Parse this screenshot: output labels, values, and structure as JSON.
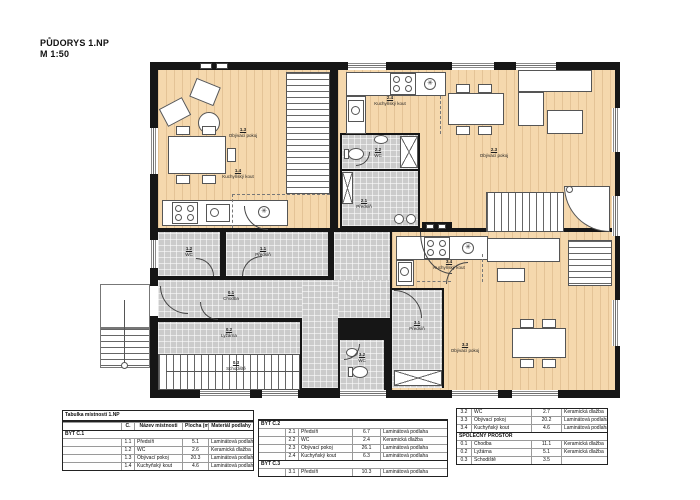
{
  "title": {
    "heading": "PŮDORYS 1.NP",
    "scale": "M 1:50"
  },
  "icons": {
    "boiler_glyph": "✳"
  },
  "colors": {
    "wall": "#161616",
    "wood_floor": "#f5d8ad",
    "tile_floor": "#cbcbcb"
  },
  "plan": {
    "rooms": [
      {
        "num": "1.3",
        "name": "Obývací pokoj"
      },
      {
        "num": "1.4",
        "name": "Kuchyňský kout"
      },
      {
        "num": "2.4",
        "name": "Kuchyňský kout"
      },
      {
        "num": "2.3",
        "name": "Obývací pokoj"
      },
      {
        "num": "2.2",
        "name": "WC"
      },
      {
        "num": "2.1",
        "name": "Předsíň"
      },
      {
        "num": "1.2",
        "name": "WC"
      },
      {
        "num": "1.1",
        "name": "Předsíň"
      },
      {
        "num": "0.1",
        "name": "Chodba"
      },
      {
        "num": "0.2",
        "name": "Lyžárna"
      },
      {
        "num": "0.3",
        "name": "Schodiště"
      },
      {
        "num": "3.2",
        "name": "WC"
      },
      {
        "num": "3.1",
        "name": "Předsíň"
      },
      {
        "num": "3.4",
        "name": "Kuchyňský kout"
      },
      {
        "num": "3.3",
        "name": "Obývací pokoj"
      }
    ]
  },
  "legend": {
    "title": "Tabulka místností 1.NP",
    "columns": [
      "Č.",
      "Název místnosti",
      "Plocha (m2)",
      "Materiál podlahy"
    ],
    "tables": [
      {
        "show_title": true,
        "show_colheader": true,
        "sections": [
          {
            "label": "BYT Č.1",
            "rows": [
              [
                "1.1",
                "Předsíň",
                "5.1",
                "Laminátová podlaha"
              ],
              [
                "1.2",
                "WC",
                "2.6",
                "Keramická dlažba"
              ],
              [
                "1.3",
                "Obývací pokoj",
                "20.3",
                "Laminátová podlaha"
              ],
              [
                "1.4",
                "Kuchyňský kout",
                "4.6",
                "Laminátová podlaha"
              ]
            ]
          }
        ]
      },
      {
        "show_title": false,
        "show_colheader": false,
        "sections": [
          {
            "label": "BYT Č.2",
            "rows": [
              [
                "2.1",
                "Předsíň",
                "6.7",
                "Laminátová podlaha"
              ],
              [
                "2.2",
                "WC",
                "2.4",
                "Keramická dlažba"
              ],
              [
                "2.3",
                "Obývací pokoj",
                "26.1",
                "Laminátová podlaha"
              ],
              [
                "2.4",
                "Kuchyňský kout",
                "6.3",
                "Laminátová podlaha"
              ]
            ]
          },
          {
            "label": "BYT Č.3",
            "rows": [
              [
                "3.1",
                "Předsíň",
                "10.3",
                "Laminátová podlaha"
              ]
            ]
          }
        ]
      },
      {
        "show_title": false,
        "show_colheader": false,
        "sections": [
          {
            "label": null,
            "rows": [
              [
                "3.2",
                "WC",
                "2.7",
                "Keramická dlažba"
              ],
              [
                "3.3",
                "Obývací pokoj",
                "20.2",
                "Laminátová podlaha"
              ],
              [
                "3.4",
                "Kuchyňský kout",
                "4.6",
                "Laminátová podlaha"
              ]
            ]
          },
          {
            "label": "SPOLEČNÝ PROSTOR",
            "rows": [
              [
                "0.1",
                "Chodba",
                "11.1",
                "Keramická dlažba"
              ],
              [
                "0.2",
                "Lyžárna",
                "5.1",
                "Keramická dlažba"
              ],
              [
                "0.3",
                "Schodiště",
                "3.5",
                ""
              ]
            ]
          }
        ]
      }
    ]
  }
}
